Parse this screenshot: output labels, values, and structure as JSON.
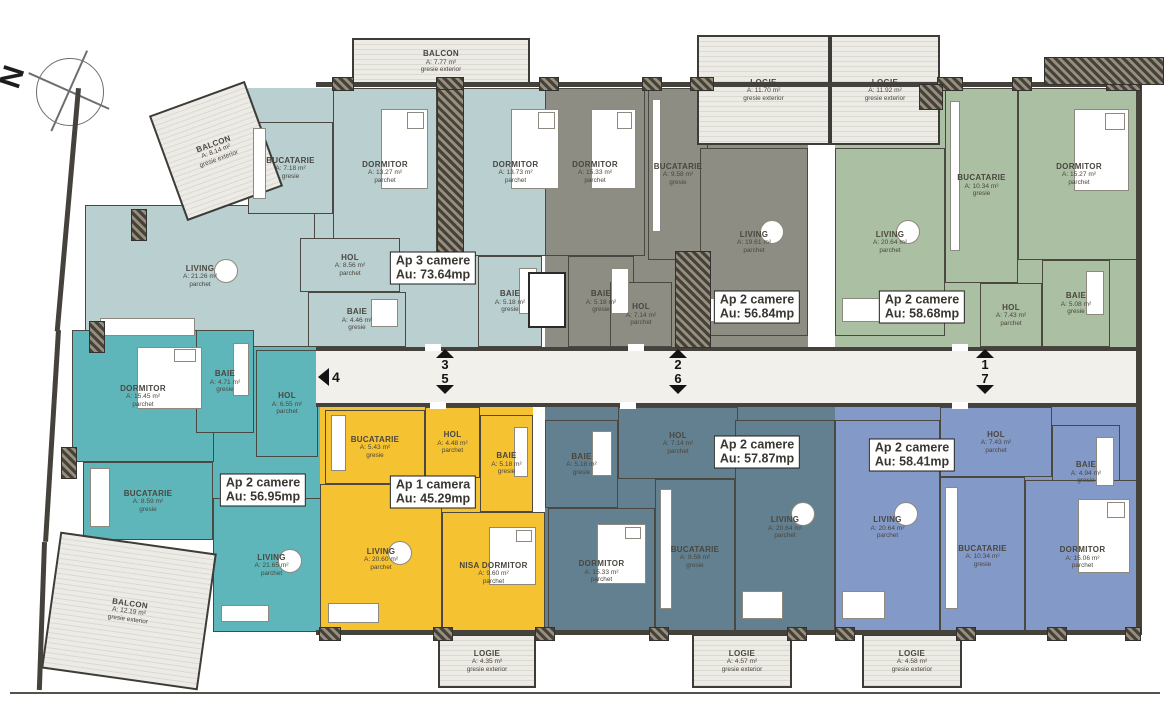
{
  "north": {
    "label": "N"
  },
  "apartments": [
    {
      "id": "ap3",
      "color": "#b9cfd0",
      "badge": {
        "line1": "Ap 3 camere",
        "line2": "Au: 73.64mp"
      },
      "badge_pos": {
        "x": 433,
        "y": 268
      }
    },
    {
      "id": "gray",
      "color": "#8d8d83",
      "badge": {
        "line1": "Ap 2 camere",
        "line2": "Au: 56.84mp"
      },
      "badge_pos": {
        "x": 757,
        "y": 307
      }
    },
    {
      "id": "green",
      "color": "#abc0a3",
      "badge": {
        "line1": "Ap 2 camere",
        "line2": "Au: 58.68mp"
      },
      "badge_pos": {
        "x": 922,
        "y": 307
      }
    },
    {
      "id": "teal",
      "color": "#5fb6ba",
      "badge": {
        "line1": "Ap 2 camere",
        "line2": "Au: 56.95mp"
      },
      "badge_pos": {
        "x": 263,
        "y": 490
      }
    },
    {
      "id": "yellow",
      "color": "#f5c231",
      "badge": {
        "line1": "Ap 1 camera",
        "line2": "Au: 45.29mp"
      },
      "badge_pos": {
        "x": 433,
        "y": 492
      }
    },
    {
      "id": "slate",
      "color": "#62808f",
      "badge": {
        "line1": "Ap 2 camere",
        "line2": "Au: 57.87mp"
      },
      "badge_pos": {
        "x": 757,
        "y": 452
      }
    },
    {
      "id": "blue",
      "color": "#8399c7",
      "badge": {
        "line1": "Ap 2 camere",
        "line2": "Au: 58.41mp"
      },
      "badge_pos": {
        "x": 912,
        "y": 455
      }
    }
  ],
  "bases": [
    {
      "apartment": "ap3",
      "rect": {
        "x": 248,
        "y": 88,
        "w": 294,
        "h": 259
      }
    },
    {
      "apartment": "gray",
      "rect": {
        "x": 545,
        "y": 88,
        "w": 263,
        "h": 259
      }
    },
    {
      "apartment": "green",
      "rect": {
        "x": 835,
        "y": 88,
        "w": 305,
        "h": 259
      }
    },
    {
      "apartment": "teal",
      "rect": {
        "x": 72,
        "y": 330,
        "w": 258,
        "h": 132
      }
    },
    {
      "apartment": "teal",
      "rect": {
        "x": 83,
        "y": 462,
        "w": 247,
        "h": 78
      }
    },
    {
      "apartment": "yellow",
      "rect": {
        "x": 320,
        "y": 407,
        "w": 213,
        "h": 227
      }
    },
    {
      "apartment": "slate",
      "rect": {
        "x": 545,
        "y": 407,
        "w": 290,
        "h": 228
      }
    },
    {
      "apartment": "blue",
      "rect": {
        "x": 835,
        "y": 407,
        "w": 305,
        "h": 228
      }
    }
  ],
  "rooms": [
    {
      "apartment": "ap3",
      "name": "LIVING",
      "area": "A: 21.26 m²",
      "finish": "parchet",
      "kind": "living",
      "rect": {
        "x": 85,
        "y": 205,
        "w": 230,
        "h": 142
      }
    },
    {
      "apartment": "ap3",
      "name": "BUCATARIE",
      "area": "A: 7.18 m²",
      "finish": "gresie",
      "kind": "kitchen",
      "rect": {
        "x": 248,
        "y": 122,
        "w": 85,
        "h": 92
      }
    },
    {
      "apartment": "ap3",
      "name": "DORMITOR",
      "area": "A: 13.27 m²",
      "finish": "parchet",
      "kind": "bedroom",
      "rect": {
        "x": 333,
        "y": 88,
        "w": 104,
        "h": 168
      }
    },
    {
      "apartment": "ap3",
      "name": "HOL",
      "area": "A: 8.56 m²",
      "finish": "parchet",
      "kind": "hol",
      "rect": {
        "x": 300,
        "y": 238,
        "w": 100,
        "h": 54
      }
    },
    {
      "apartment": "ap3",
      "name": "BAIE",
      "area": "A: 4.46 m²",
      "finish": "gresie",
      "kind": "bath",
      "rect": {
        "x": 308,
        "y": 292,
        "w": 98,
        "h": 55
      }
    },
    {
      "apartment": "ap3",
      "name": "DORMITOR",
      "area": "A: 13.73 m²",
      "finish": "parchet",
      "kind": "bedroom",
      "rect": {
        "x": 463,
        "y": 88,
        "w": 105,
        "h": 168
      }
    },
    {
      "apartment": "ap3",
      "name": "BAIE",
      "area": "A: 5.18 m²",
      "finish": "gresie",
      "kind": "bath",
      "rect": {
        "x": 478,
        "y": 256,
        "w": 64,
        "h": 91
      }
    },
    {
      "apartment": null,
      "name": "BALCON",
      "area": "A: 8.14 m²",
      "finish": "gresie exterior",
      "kind": "balcony",
      "rect": {
        "x": 165,
        "y": 95,
        "w": 102,
        "h": 112
      },
      "rotate": -20
    },
    {
      "apartment": null,
      "name": "BALCON",
      "area": "A: 7.77 m²",
      "finish": "gresie exterior",
      "kind": "balcony",
      "rect": {
        "x": 352,
        "y": 38,
        "w": 178,
        "h": 47
      }
    },
    {
      "apartment": "gray",
      "name": "DORMITOR",
      "area": "A: 15.33 m²",
      "finish": "parchet",
      "kind": "bedroom",
      "rect": {
        "x": 545,
        "y": 88,
        "w": 100,
        "h": 168
      }
    },
    {
      "apartment": "gray",
      "name": "BAIE",
      "area": "A: 5.18 m²",
      "finish": "gresie",
      "kind": "bath",
      "rect": {
        "x": 568,
        "y": 256,
        "w": 66,
        "h": 91
      }
    },
    {
      "apartment": "gray",
      "name": "BUCATARIE",
      "area": "A: 9.58 m²",
      "finish": "gresie",
      "kind": "kitchen",
      "rect": {
        "x": 648,
        "y": 88,
        "w": 60,
        "h": 172
      }
    },
    {
      "apartment": "gray",
      "name": "LIVING",
      "area": "A: 19.61 m²",
      "finish": "parchet",
      "kind": "living",
      "rect": {
        "x": 700,
        "y": 148,
        "w": 108,
        "h": 188
      }
    },
    {
      "apartment": "gray",
      "name": "HOL",
      "area": "A: 7.14 m²",
      "finish": "parchet",
      "kind": "hol",
      "rect": {
        "x": 610,
        "y": 282,
        "w": 62,
        "h": 65
      }
    },
    {
      "apartment": null,
      "name": "LOGIE",
      "area": "A: 11.70 m²",
      "finish": "gresie exterior",
      "kind": "logie",
      "rect": {
        "x": 697,
        "y": 35,
        "w": 133,
        "h": 110
      }
    },
    {
      "apartment": null,
      "name": "LOGIE",
      "area": "A: 11.92 m²",
      "finish": "gresie exterior",
      "kind": "logie",
      "rect": {
        "x": 830,
        "y": 35,
        "w": 110,
        "h": 110
      }
    },
    {
      "apartment": "green",
      "name": "LIVING",
      "area": "A: 20.64 m²",
      "finish": "parchet",
      "kind": "living",
      "rect": {
        "x": 835,
        "y": 148,
        "w": 110,
        "h": 188
      }
    },
    {
      "apartment": "green",
      "name": "BUCATARIE",
      "area": "A: 10.34 m²",
      "finish": "gresie",
      "kind": "kitchen",
      "rect": {
        "x": 945,
        "y": 88,
        "w": 73,
        "h": 195
      }
    },
    {
      "apartment": "green",
      "name": "DORMITOR",
      "area": "A: 15.27 m²",
      "finish": "parchet",
      "kind": "bedroom",
      "rect": {
        "x": 1018,
        "y": 88,
        "w": 122,
        "h": 172
      }
    },
    {
      "apartment": "green",
      "name": "BAIE",
      "area": "A: 5.08 m²",
      "finish": "gresie",
      "kind": "bath",
      "rect": {
        "x": 1042,
        "y": 260,
        "w": 68,
        "h": 87
      }
    },
    {
      "apartment": "green",
      "name": "HOL",
      "area": "A: 7.43 m²",
      "finish": "parchet",
      "kind": "hol",
      "rect": {
        "x": 980,
        "y": 283,
        "w": 62,
        "h": 64
      }
    },
    {
      "apartment": "teal",
      "name": "DORMITOR",
      "area": "A: 15.45 m²",
      "finish": "parchet",
      "kind": "bedroom",
      "rect": {
        "x": 72,
        "y": 330,
        "w": 142,
        "h": 132
      }
    },
    {
      "apartment": "teal",
      "name": "BAIE",
      "area": "A: 4.71 m²",
      "finish": "gresie",
      "kind": "bath",
      "rect": {
        "x": 196,
        "y": 330,
        "w": 58,
        "h": 103
      }
    },
    {
      "apartment": "teal",
      "name": "HOL",
      "area": "A: 6.55 m²",
      "finish": "parchet",
      "kind": "hol",
      "rect": {
        "x": 256,
        "y": 350,
        "w": 62,
        "h": 107
      }
    },
    {
      "apartment": "teal",
      "name": "BUCATARIE",
      "area": "A: 8.59 m²",
      "finish": "gresie",
      "kind": "kitchen",
      "rect": {
        "x": 83,
        "y": 462,
        "w": 130,
        "h": 78
      }
    },
    {
      "apartment": "teal",
      "name": "LIVING",
      "area": "A: 21.65 m²",
      "finish": "parchet",
      "kind": "living",
      "rect": {
        "x": 213,
        "y": 498,
        "w": 117,
        "h": 134
      }
    },
    {
      "apartment": null,
      "name": "BALCON",
      "area": "A: 12.19 m²",
      "finish": "gresie exterior",
      "kind": "balcony",
      "rect": {
        "x": 50,
        "y": 542,
        "w": 158,
        "h": 138
      },
      "rotate": 8
    },
    {
      "apartment": "yellow",
      "name": "BUCATARIE",
      "area": "A: 5.43 m²",
      "finish": "gresie",
      "kind": "kitchen",
      "rect": {
        "x": 325,
        "y": 410,
        "w": 100,
        "h": 74
      }
    },
    {
      "apartment": "yellow",
      "name": "HOL",
      "area": "A: 4.48 m²",
      "finish": "parchet",
      "kind": "hol",
      "rect": {
        "x": 425,
        "y": 407,
        "w": 55,
        "h": 71
      }
    },
    {
      "apartment": "yellow",
      "name": "BAIE",
      "area": "A: 5.18 m²",
      "finish": "gresie",
      "kind": "bath",
      "rect": {
        "x": 480,
        "y": 415,
        "w": 53,
        "h": 97
      }
    },
    {
      "apartment": "yellow",
      "name": "LIVING",
      "area": "A: 20.60 m²",
      "finish": "parchet",
      "kind": "living",
      "rect": {
        "x": 320,
        "y": 484,
        "w": 122,
        "h": 150
      }
    },
    {
      "apartment": "yellow",
      "name": "NISA DORMITOR",
      "area": "A: 9.60 m²",
      "finish": "parchet",
      "kind": "bedroom",
      "rect": {
        "x": 442,
        "y": 512,
        "w": 103,
        "h": 122
      }
    },
    {
      "apartment": null,
      "name": "LOGIE",
      "area": "A: 4.35 m²",
      "finish": "gresie exterior",
      "kind": "logie",
      "rect": {
        "x": 438,
        "y": 634,
        "w": 98,
        "h": 54
      }
    },
    {
      "apartment": "slate",
      "name": "HOL",
      "area": "A: 7.14 m²",
      "finish": "parchet",
      "kind": "hol",
      "rect": {
        "x": 618,
        "y": 407,
        "w": 120,
        "h": 72
      }
    },
    {
      "apartment": "slate",
      "name": "BAIE",
      "area": "A: 5.18 m²",
      "finish": "gresie",
      "kind": "bath",
      "rect": {
        "x": 545,
        "y": 420,
        "w": 73,
        "h": 88
      }
    },
    {
      "apartment": "slate",
      "name": "DORMITOR",
      "area": "A: 15.33 m²",
      "finish": "parchet",
      "kind": "bedroom",
      "rect": {
        "x": 548,
        "y": 508,
        "w": 107,
        "h": 127
      }
    },
    {
      "apartment": "slate",
      "name": "BUCATARIE",
      "area": "A: 9.58 m²",
      "finish": "gresie",
      "kind": "kitchen",
      "rect": {
        "x": 655,
        "y": 479,
        "w": 80,
        "h": 156
      }
    },
    {
      "apartment": "slate",
      "name": "LIVING",
      "area": "A: 20.64 m²",
      "finish": "parchet",
      "kind": "living",
      "rect": {
        "x": 735,
        "y": 420,
        "w": 100,
        "h": 215
      }
    },
    {
      "apartment": null,
      "name": "LOGIE",
      "area": "A: 4.57 m²",
      "finish": "gresie exterior",
      "kind": "logie",
      "rect": {
        "x": 692,
        "y": 634,
        "w": 100,
        "h": 54
      }
    },
    {
      "apartment": "blue",
      "name": "HOL",
      "area": "A: 7.43 m²",
      "finish": "parchet",
      "kind": "hol",
      "rect": {
        "x": 940,
        "y": 407,
        "w": 112,
        "h": 70
      }
    },
    {
      "apartment": "blue",
      "name": "LIVING",
      "area": "A: 20.64 m²",
      "finish": "parchet",
      "kind": "living",
      "rect": {
        "x": 835,
        "y": 420,
        "w": 105,
        "h": 215
      }
    },
    {
      "apartment": "blue",
      "name": "BAIE",
      "area": "A: 4.94 m²",
      "finish": "gresie",
      "kind": "bath",
      "rect": {
        "x": 1052,
        "y": 425,
        "w": 68,
        "h": 95
      }
    },
    {
      "apartment": "blue",
      "name": "BUCATARIE",
      "area": "A: 10.34 m²",
      "finish": "gresie",
      "kind": "kitchen",
      "rect": {
        "x": 940,
        "y": 477,
        "w": 85,
        "h": 158
      }
    },
    {
      "apartment": "blue",
      "name": "DORMITOR",
      "area": "A: 15.06 m²",
      "finish": "parchet",
      "kind": "bedroom",
      "rect": {
        "x": 1025,
        "y": 480,
        "w": 115,
        "h": 155
      }
    },
    {
      "apartment": null,
      "name": "LOGIE",
      "area": "A: 4.58 m²",
      "finish": "gresie exterior",
      "kind": "logie",
      "rect": {
        "x": 862,
        "y": 634,
        "w": 100,
        "h": 54
      }
    }
  ],
  "corridor": {
    "rect": {
      "x": 316,
      "y": 347,
      "w": 820,
      "h": 60
    },
    "left_marker": {
      "label": "4"
    },
    "stacks": [
      {
        "top": "3",
        "bottom": "5",
        "x": 445
      },
      {
        "top": "2",
        "bottom": "6",
        "x": 678
      },
      {
        "top": "1",
        "bottom": "7",
        "x": 985
      }
    ]
  }
}
